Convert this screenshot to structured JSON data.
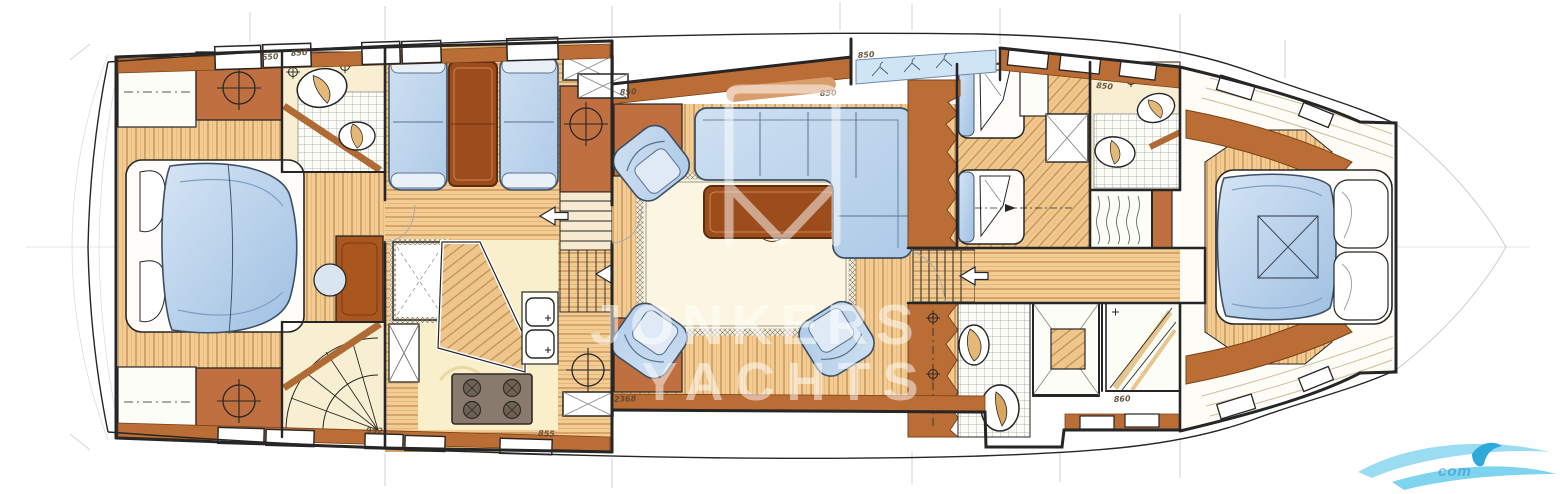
{
  "watermark": {
    "text_line1": "JONKERS",
    "text_line2": "YACHTS",
    "logo": "envelope-sail-watermark",
    "color": "#ffffff",
    "opacity": 0.5
  },
  "corner_logo": {
    "name": "wave-swoosh-logo",
    "text": "com",
    "primary": "#8fd8f0",
    "accent": "#2fa8da"
  },
  "annotations": [
    {
      "text": "650",
      "x": 262,
      "y": 60,
      "rot": -4
    },
    {
      "text": "850",
      "x": 291,
      "y": 56,
      "rot": -4
    },
    {
      "text": "850",
      "x": 620,
      "y": 95,
      "rot": -3
    },
    {
      "text": "850",
      "x": 820,
      "y": 96,
      "rot": -2
    },
    {
      "text": "850",
      "x": 858,
      "y": 58,
      "rot": -4
    },
    {
      "text": "850",
      "x": 1096,
      "y": 88,
      "rot": 5
    },
    {
      "text": "2368",
      "x": 614,
      "y": 402,
      "rot": -2
    },
    {
      "text": "952",
      "x": 366,
      "y": 433,
      "rot": 2
    },
    {
      "text": "855",
      "x": 538,
      "y": 436,
      "rot": 2
    },
    {
      "text": "860",
      "x": 1114,
      "y": 402,
      "rot": -3
    }
  ],
  "colors": {
    "ink": "#262626",
    "pencil": "#a2a7ad",
    "wood_light": "#f2cc93",
    "wood_stripe": "#c58d4f",
    "wood_mid": "#c07040",
    "wood_band": "#bb6d36",
    "wood_dark": "#9d4d1c",
    "floor_pale": "#f9efcb",
    "fabric_blue": "#b7cfea",
    "fabric_blue_deep": "#9fc0e2",
    "mosaic_line": "#969c9c",
    "watermark": "#ffffff",
    "wave_blue": "#8fd8f0",
    "wave_blue_deep": "#2fa8da"
  }
}
